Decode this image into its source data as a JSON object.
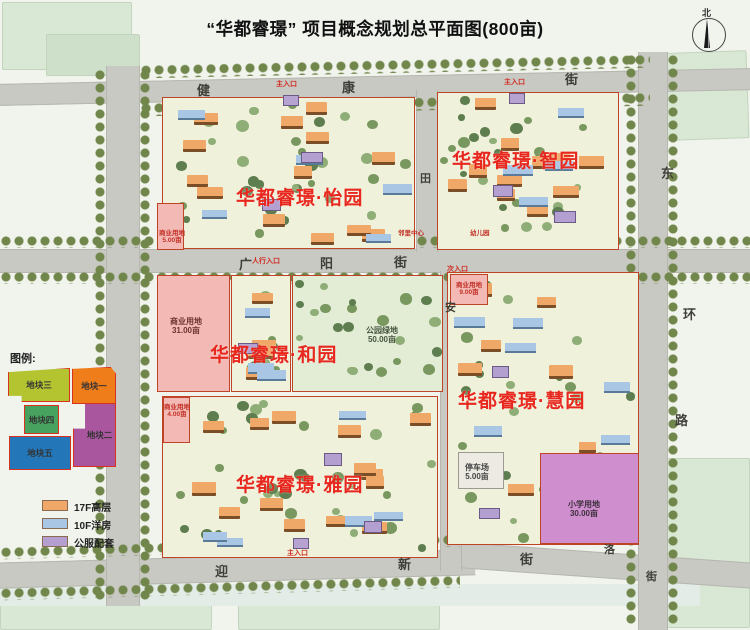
{
  "title": "“华都睿璟” 项目概念规划总平面图(800亩)",
  "compass": {
    "north_label": "北"
  },
  "streets": {
    "top": {
      "name": "健康街",
      "chars": [
        "健",
        "康",
        "街"
      ]
    },
    "middle": {
      "name": "广阳街",
      "chars": [
        "广",
        "阳",
        "街"
      ]
    },
    "bottom": {
      "name": "迎新街",
      "chars": [
        "迎",
        "新",
        "街"
      ]
    },
    "right": {
      "name": "东环路",
      "chars": [
        "东",
        "环",
        "路"
      ]
    },
    "inner_top_vertical": {
      "chars": [
        "田"
      ]
    },
    "inner_mid_vertical": {
      "chars": [
        "安"
      ]
    },
    "bottom_right": {
      "chars": [
        "洛",
        "街"
      ]
    }
  },
  "districts": [
    {
      "name": "华都睿璟·怡园"
    },
    {
      "name": "华都睿璟·智园"
    },
    {
      "name": "华都睿璟·和园"
    },
    {
      "name": "华都睿璟·雅园"
    },
    {
      "name": "华都睿璟·慧园"
    }
  ],
  "land_labels": [
    {
      "name": "商业用地",
      "area": "31.00亩"
    },
    {
      "name": "公园绿地",
      "area": "50.00亩"
    },
    {
      "name": "小学用地",
      "area": "30.00亩"
    },
    {
      "name": "停车场",
      "area": "5.00亩"
    },
    {
      "name": "商业用地",
      "area": "5.00亩"
    },
    {
      "name": "商业用地",
      "area": "9.00亩"
    },
    {
      "name": "商业用地",
      "area": "4.00亩"
    },
    {
      "name": "邻里中心",
      "area": ""
    },
    {
      "name": "幼儿园",
      "area": ""
    }
  ],
  "entrances": [
    {
      "label": "主入口"
    },
    {
      "label": "主入口"
    },
    {
      "label": "主入口"
    },
    {
      "label": "人行入口"
    },
    {
      "label": "次入口"
    }
  ],
  "legend": {
    "title": "图例:",
    "plots": [
      {
        "label": "地块一",
        "color": "#ef7d1a"
      },
      {
        "label": "地块二",
        "color": "#a9569f"
      },
      {
        "label": "地块三",
        "color": "#b4c431"
      },
      {
        "label": "地块四",
        "color": "#47a25f"
      },
      {
        "label": "地块五",
        "color": "#2377b8"
      }
    ]
  },
  "building_legend": [
    {
      "label": "17F高层",
      "color": "#f0a868"
    },
    {
      "label": "10F洋房",
      "color": "#a9c6e4"
    },
    {
      "label": "公服配套",
      "color": "#b39fd0"
    }
  ]
}
